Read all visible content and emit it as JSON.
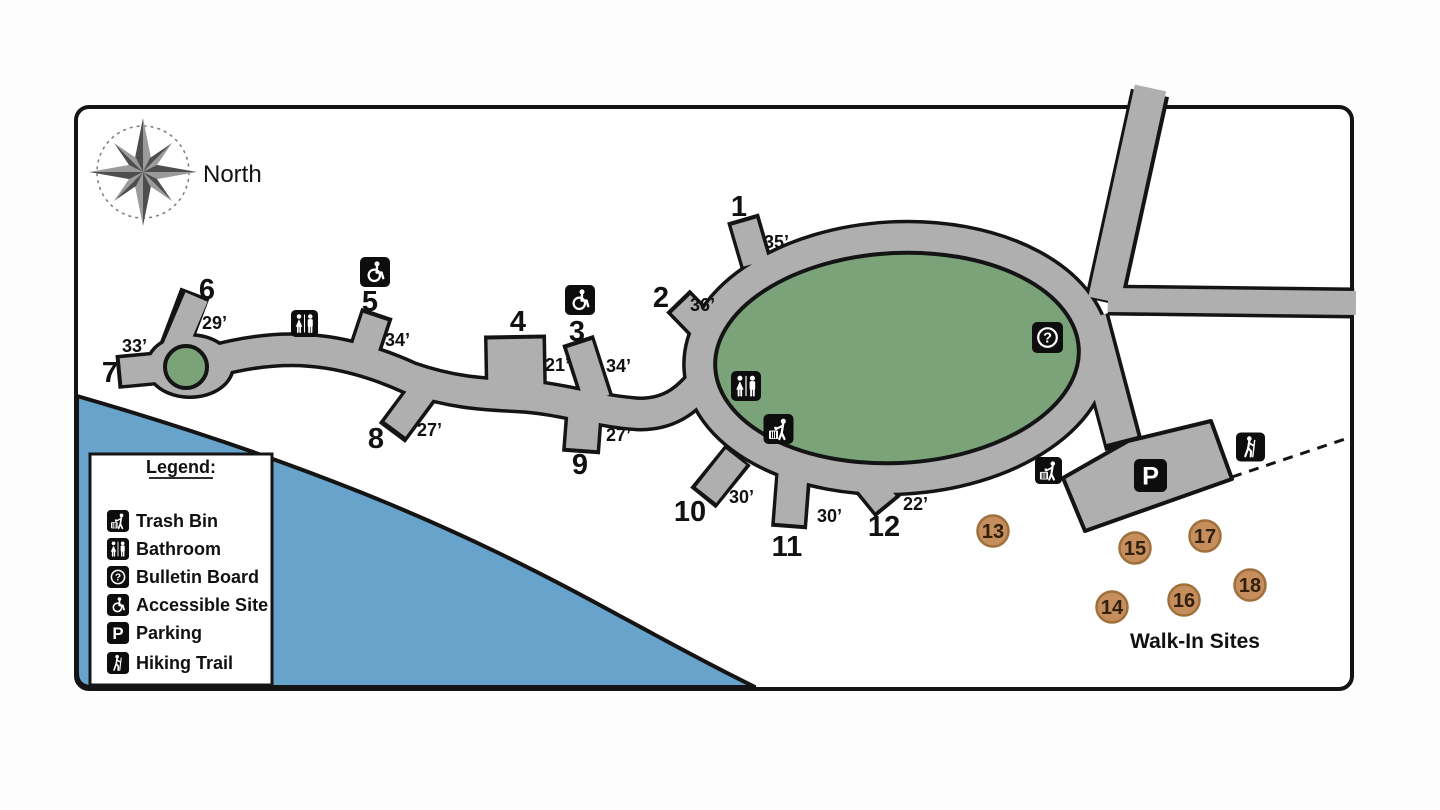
{
  "colors": {
    "water": "#68A3CB",
    "road": "#AFAFAF",
    "green": "#7AA379",
    "tan": "#C68E5C",
    "tanEdge": "#A0703C",
    "outline": "#141414"
  },
  "compass": {
    "label": "North"
  },
  "sites": [
    {
      "num": "1",
      "dist": "35’"
    },
    {
      "num": "2",
      "dist": "36’"
    },
    {
      "num": "3",
      "dist": "34’"
    },
    {
      "num": "4",
      "dist": "21’"
    },
    {
      "num": "5",
      "dist": "34’"
    },
    {
      "num": "6",
      "dist": "29’"
    },
    {
      "num": "7",
      "dist": "33’"
    },
    {
      "num": "8",
      "dist": "27’"
    },
    {
      "num": "9",
      "dist": "27’"
    },
    {
      "num": "10",
      "dist": "30’"
    },
    {
      "num": "11",
      "dist": "30’"
    },
    {
      "num": "12",
      "dist": "22’"
    }
  ],
  "walk_in": {
    "label": "Walk-In Sites",
    "sites": [
      "13",
      "14",
      "15",
      "16",
      "17",
      "18"
    ]
  },
  "legend": {
    "title": "Legend:",
    "items": [
      {
        "icon": "trash-bin-icon",
        "label": "Trash Bin"
      },
      {
        "icon": "bathroom-icon",
        "label": "Bathroom"
      },
      {
        "icon": "bulletin-board-icon",
        "label": "Bulletin Board"
      },
      {
        "icon": "accessible-site-icon",
        "label": "Accessible Site"
      },
      {
        "icon": "parking-icon",
        "label": "Parking"
      },
      {
        "icon": "hiking-trail-icon",
        "label": "Hiking Trail"
      }
    ]
  },
  "icons": {
    "parking_glyph": "P",
    "question_glyph": "?"
  },
  "map_icons": [
    "trash-bin-icon",
    "bathroom-icon",
    "bulletin-board-icon",
    "accessible-site-icon",
    "parking-icon",
    "hiking-trail-icon"
  ]
}
